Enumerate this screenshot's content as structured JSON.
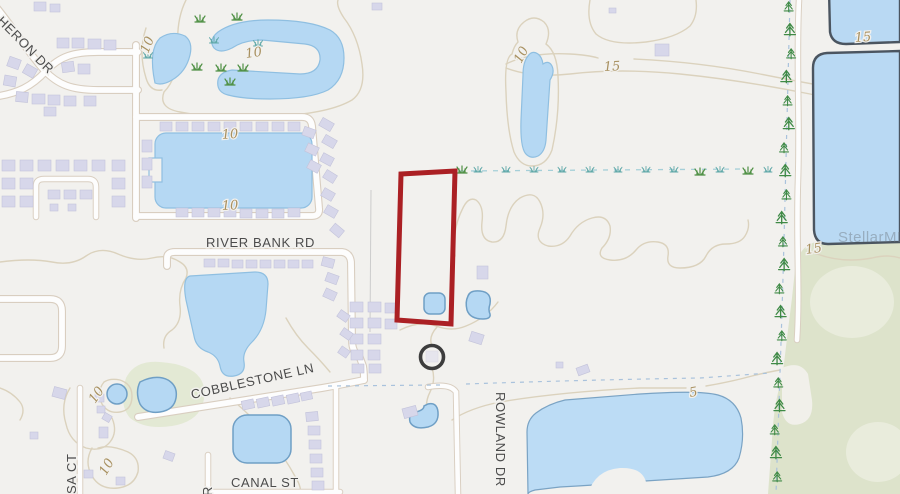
{
  "map": {
    "watermark": "StellarMLS",
    "streets": {
      "heron": "N HERON DR",
      "river_bank": "RIVER BANK RD",
      "cobblestone": "COBBLESTONE LN",
      "canal": "CANAL ST",
      "sa_court": "SA CT",
      "rowland": "ROWLAND DR",
      "partial_dr": "DR"
    },
    "elevation_labels": {
      "ten": "10",
      "fifteen": "15",
      "five": "5"
    },
    "colors": {
      "property_outline": "#ab2024",
      "water": "#b5d8f3",
      "lake_border": "#4b5560",
      "road": "#fdfdfd",
      "contour": "#dbd2bd",
      "building": "#d7d7ea",
      "greenspace": "#e3e9d4",
      "background": "#f2f1ee"
    }
  }
}
